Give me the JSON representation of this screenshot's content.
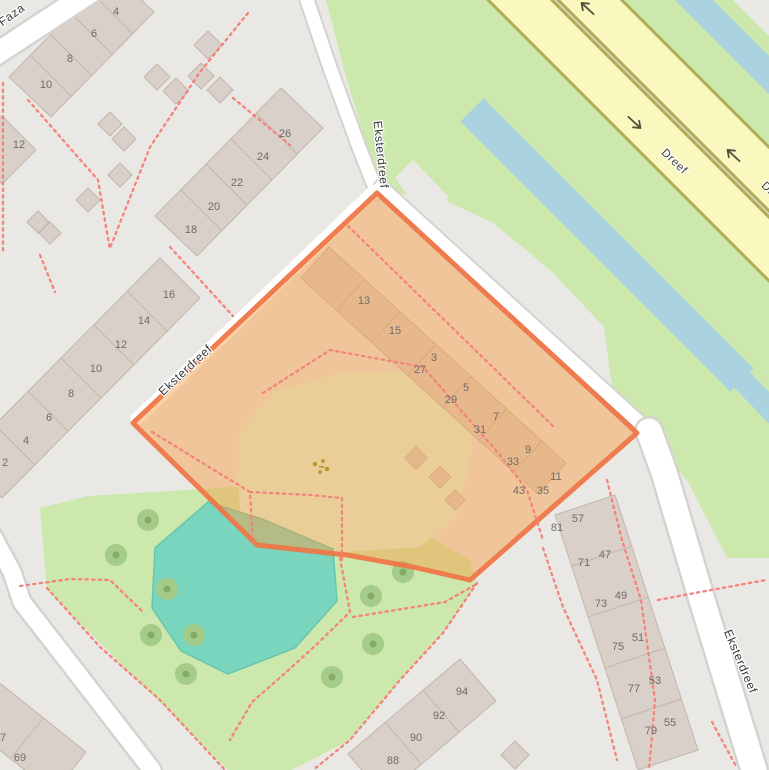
{
  "street_labels": [
    {
      "text": "Faza",
      "x": 14,
      "y": 18,
      "rot": -36,
      "cls": ""
    },
    {
      "text": "Eksterdreef",
      "x": 377,
      "y": 155,
      "rot": 84,
      "cls": ""
    },
    {
      "text": "Eksterdreef",
      "x": 188,
      "y": 373,
      "rot": -43,
      "cls": ""
    },
    {
      "text": "Eksterdreef",
      "x": 737,
      "y": 663,
      "rot": 67,
      "cls": ""
    },
    {
      "text": "Dreef",
      "x": 672,
      "y": 164,
      "rot": 44,
      "cls": "dreef"
    },
    {
      "text": "Dreef",
      "x": 772,
      "y": 197,
      "rot": 44,
      "cls": "dreef"
    }
  ],
  "housenumbers": [
    {
      "t": "4",
      "x": 116,
      "y": 11
    },
    {
      "t": "6",
      "x": 94,
      "y": 33
    },
    {
      "t": "8",
      "x": 70,
      "y": 58
    },
    {
      "t": "10",
      "x": 46,
      "y": 84
    },
    {
      "t": "12",
      "x": 19,
      "y": 144
    },
    {
      "t": "26",
      "x": 285,
      "y": 133
    },
    {
      "t": "24",
      "x": 263,
      "y": 156
    },
    {
      "t": "22",
      "x": 237,
      "y": 182
    },
    {
      "t": "20",
      "x": 214,
      "y": 206
    },
    {
      "t": "18",
      "x": 191,
      "y": 229
    },
    {
      "t": "16",
      "x": 169,
      "y": 294
    },
    {
      "t": "14",
      "x": 144,
      "y": 320
    },
    {
      "t": "12",
      "x": 121,
      "y": 344
    },
    {
      "t": "10",
      "x": 96,
      "y": 368
    },
    {
      "t": "8",
      "x": 71,
      "y": 393
    },
    {
      "t": "6",
      "x": 49,
      "y": 417
    },
    {
      "t": "4",
      "x": 26,
      "y": 440
    },
    {
      "t": "2",
      "x": 5,
      "y": 462
    },
    {
      "t": "13",
      "x": 364,
      "y": 300
    },
    {
      "t": "15",
      "x": 395,
      "y": 330
    },
    {
      "t": "3",
      "x": 434,
      "y": 357
    },
    {
      "t": "27",
      "x": 420,
      "y": 369
    },
    {
      "t": "5",
      "x": 466,
      "y": 387
    },
    {
      "t": "29",
      "x": 451,
      "y": 399
    },
    {
      "t": "7",
      "x": 496,
      "y": 416
    },
    {
      "t": "31",
      "x": 480,
      "y": 429
    },
    {
      "t": "9",
      "x": 528,
      "y": 449
    },
    {
      "t": "33",
      "x": 513,
      "y": 461
    },
    {
      "t": "11",
      "x": 556,
      "y": 476
    },
    {
      "t": "43",
      "x": 519,
      "y": 490
    },
    {
      "t": "35",
      "x": 543,
      "y": 490
    },
    {
      "t": "81",
      "x": 557,
      "y": 527
    },
    {
      "t": "57",
      "x": 578,
      "y": 518
    },
    {
      "t": "71",
      "x": 584,
      "y": 562
    },
    {
      "t": "47",
      "x": 605,
      "y": 554
    },
    {
      "t": "73",
      "x": 601,
      "y": 603
    },
    {
      "t": "49",
      "x": 621,
      "y": 595
    },
    {
      "t": "75",
      "x": 618,
      "y": 646
    },
    {
      "t": "51",
      "x": 638,
      "y": 637
    },
    {
      "t": "77",
      "x": 634,
      "y": 688
    },
    {
      "t": "53",
      "x": 655,
      "y": 680
    },
    {
      "t": "79",
      "x": 651,
      "y": 730
    },
    {
      "t": "55",
      "x": 670,
      "y": 722
    },
    {
      "t": "94",
      "x": 462,
      "y": 691
    },
    {
      "t": "92",
      "x": 439,
      "y": 715
    },
    {
      "t": "90",
      "x": 416,
      "y": 737
    },
    {
      "t": "88",
      "x": 393,
      "y": 760
    },
    {
      "t": "67",
      "x": 0,
      "y": 737
    },
    {
      "t": "69",
      "x": 20,
      "y": 757
    }
  ],
  "oneway_arrows": [
    {
      "x": 587,
      "y": 8,
      "rot": -137
    },
    {
      "x": 635,
      "y": 123,
      "rot": 43
    },
    {
      "x": 733,
      "y": 155,
      "rot": -137
    }
  ],
  "trees": [
    {
      "x": 148,
      "y": 520
    },
    {
      "x": 116,
      "y": 555
    },
    {
      "x": 167,
      "y": 589
    },
    {
      "x": 151,
      "y": 635
    },
    {
      "x": 194,
      "y": 635
    },
    {
      "x": 186,
      "y": 674
    },
    {
      "x": 403,
      "y": 572
    },
    {
      "x": 371,
      "y": 596
    },
    {
      "x": 373,
      "y": 644
    },
    {
      "x": 332,
      "y": 677
    }
  ],
  "colors": {
    "background": "#e9e8e4",
    "selection_fill": "rgba(245,158,70,0.5)",
    "selection_border": "#f07747",
    "park_green": "#cde8ad",
    "pond_teal": "#79d5bd",
    "water_blue": "#aad3df",
    "playground": "#defce0",
    "building": "#d9d0c9",
    "road_white": "#ffffff",
    "road_yellow": "#faf7bf",
    "road_yellow_casing": "#b0ad57",
    "footpath_red": "#f5837c"
  }
}
